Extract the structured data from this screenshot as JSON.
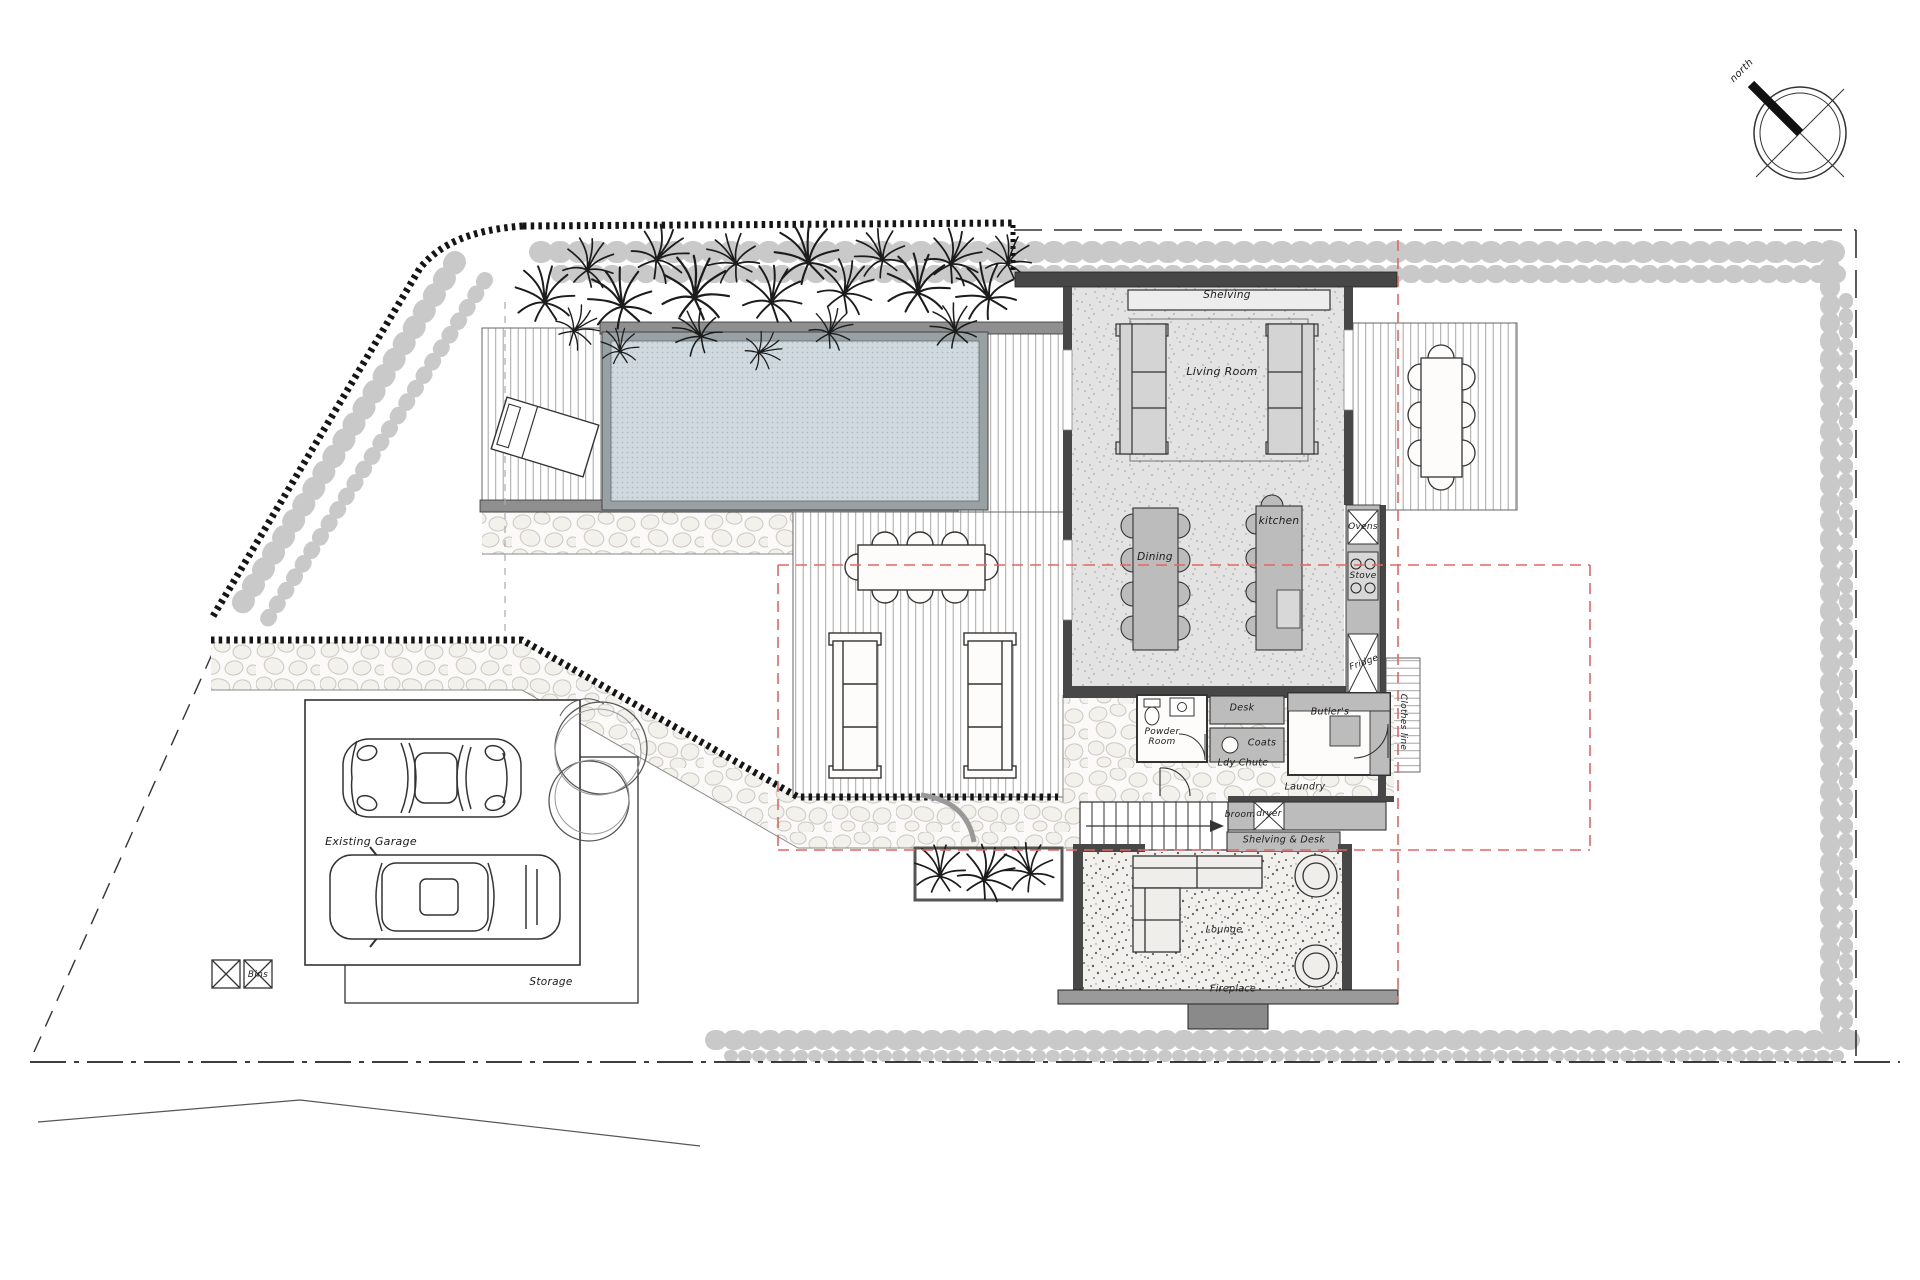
{
  "plan": {
    "compass_label": "north",
    "house": {
      "shelving": "Shelving",
      "living_room": "Living Room",
      "dining": "Dining",
      "kitchen": "kitchen",
      "ovens": "Ovens",
      "stove": "Stove",
      "fridge": "Fridge",
      "desk": "Desk",
      "coats": "Coats",
      "butlers": "Butler's",
      "powder_room": "Powder Room",
      "ldy_chute": "Ldy Chute",
      "laundry": "Laundry",
      "broom": "broom",
      "dryer": "dryer",
      "shelving_desk": "Shelving & Desk",
      "lounge": "Lounge",
      "fireplace": "Fireplace",
      "clothes_line": "Clothes line"
    },
    "site": {
      "existing_garage": "Existing Garage",
      "storage": "Storage",
      "bins": "Bins"
    },
    "colors": {
      "wall": "#474747",
      "furniture": "#bcbcbc",
      "pool_water": "#cfd9de",
      "setback_line": "#e06666",
      "hedge": "#c9c9c9"
    }
  }
}
